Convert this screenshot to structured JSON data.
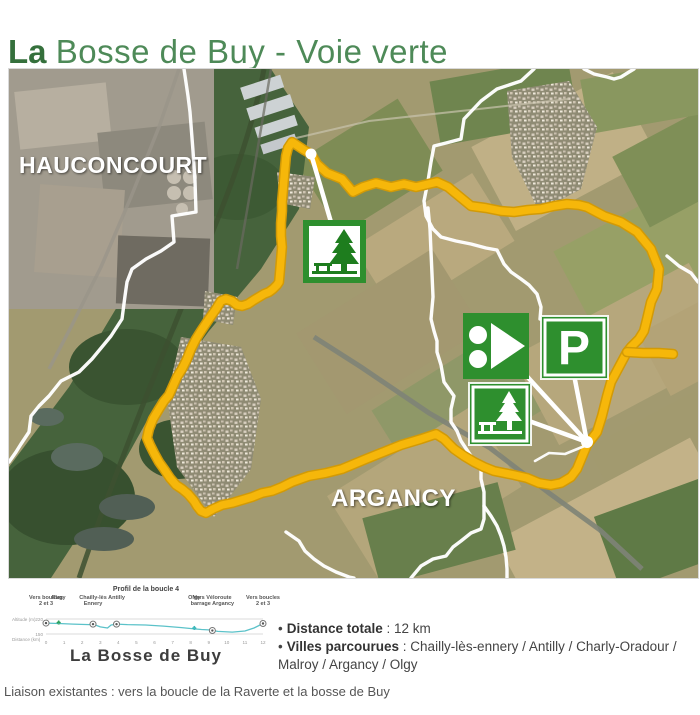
{
  "title": {
    "bold": "La",
    "rest": "Bosse de Buy - Voie verte"
  },
  "map": {
    "towns": {
      "hauconcourt": "HAUCONCOURT",
      "argancy": "ARGANCY"
    },
    "parking_letter": "P",
    "icon_names": [
      "picnic-area",
      "route-start",
      "parking",
      "picnic-area"
    ],
    "colors": {
      "route": "#F6B70A",
      "sign_green": "#2E8F2E",
      "boundary": "#FFFFFF"
    }
  },
  "profile": {
    "title": "Profil de la boucle 4",
    "caption": "La Bosse de Buy",
    "ylabel": "Altitude (m)",
    "xlabel": "Distance (km)",
    "yticks": [
      "220",
      "150"
    ],
    "xticks": [
      0,
      1,
      2,
      3,
      4,
      5,
      6,
      7,
      8,
      9,
      10,
      11,
      12
    ],
    "waypoints": [
      {
        "label": "Vers boucles\n2 et 3",
        "km": 0,
        "marker": "circle"
      },
      {
        "label": "Rugy",
        "km": 0.7,
        "marker": "green"
      },
      {
        "label": "Chailly-lès\nEnnery",
        "km": 2.6,
        "marker": "circle"
      },
      {
        "label": "Antilly",
        "km": 3.9,
        "marker": "circle"
      },
      {
        "label": "Olgy",
        "km": 8.2,
        "marker": "teal"
      },
      {
        "label": "Vers Véloroute\nbarrage Argancy",
        "km": 9.2,
        "marker": "circle"
      },
      {
        "label": "Vers boucles\n2 et 3",
        "km": 12,
        "marker": "circle"
      }
    ]
  },
  "chart_data": {
    "type": "line",
    "title": "Profil de la boucle 4",
    "xlabel": "Distance (km)",
    "ylabel": "Altitude (m)",
    "xlim": [
      0,
      12
    ],
    "ylim": [
      150,
      220
    ],
    "x": [
      0,
      0.7,
      1.5,
      2.4,
      2.6,
      3.0,
      3.4,
      3.6,
      3.9,
      4.5,
      5.5,
      6.5,
      7.5,
      8.2,
      8.6,
      9.0,
      9.5,
      10.3,
      11.0,
      11.5,
      12
    ],
    "y": [
      201,
      199,
      196,
      194,
      196,
      183,
      178,
      192,
      196,
      194,
      192,
      187,
      180,
      174,
      171,
      169,
      162,
      159,
      164,
      178,
      199
    ]
  },
  "details": {
    "bullet": "•",
    "distance_label": "Distance totale",
    "distance_value": " : 12 km",
    "villes_label": "Villes parcourues",
    "villes_value": " : Chailly-lès-ennery / Antilly / Charly-Oradour / Malroy / Argancy / Olgy"
  },
  "footer": {
    "liaison": "Liaison existantes : vers la boucle de la Raverte et la bosse de Buy"
  }
}
